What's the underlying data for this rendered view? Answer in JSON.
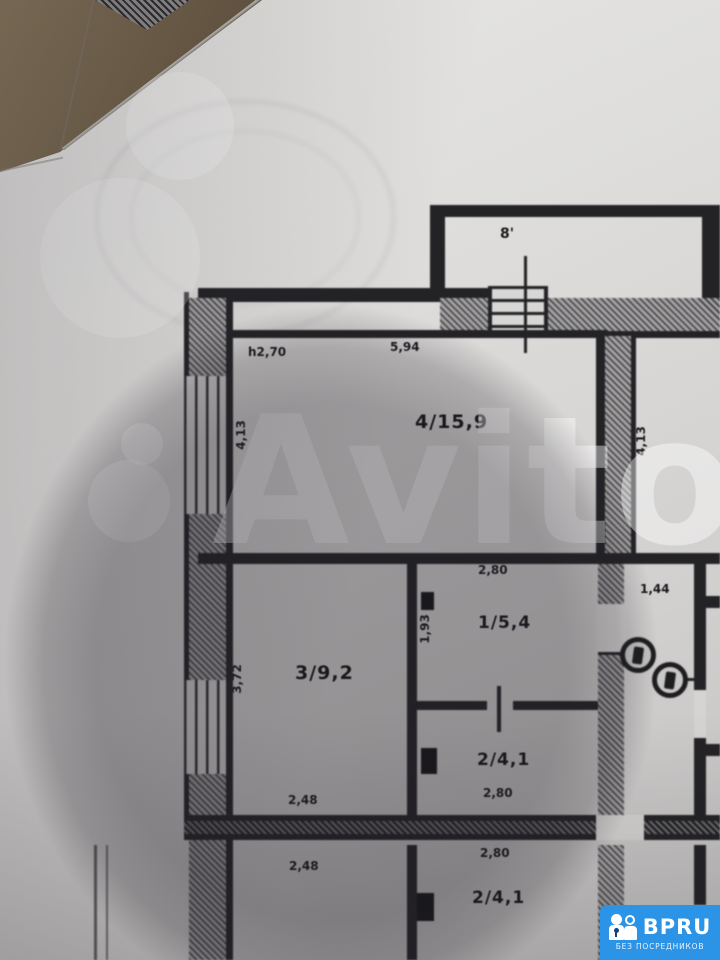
{
  "floorplan": {
    "balcony_label": "8'",
    "ceiling_height_note": "h2,70",
    "room4": {
      "label": "4/15,9",
      "width_top": "5,94",
      "depth_left": "4,13"
    },
    "right_room_depth": "4,13",
    "room1": {
      "label": "1/5,4",
      "width_top": "2,80",
      "depth_left": "1,93"
    },
    "room2": {
      "label": "2/4,1",
      "width_bottom": "2,80"
    },
    "room3": {
      "label": "3/9,2",
      "depth_left": "3,72",
      "width_bottom": "2,48"
    },
    "corridor_width_top": "1,44",
    "lower_unit": {
      "left_room_width_top": "2,48",
      "room2_label": "2/4,1",
      "room2_width_top": "2,80"
    }
  },
  "watermark": {
    "text": "Avito"
  },
  "overlay_logo": {
    "brand": "BPRU",
    "tagline": "БЕЗ ПОСРЕДНИКОВ",
    "background_color": "#2b94e7"
  }
}
